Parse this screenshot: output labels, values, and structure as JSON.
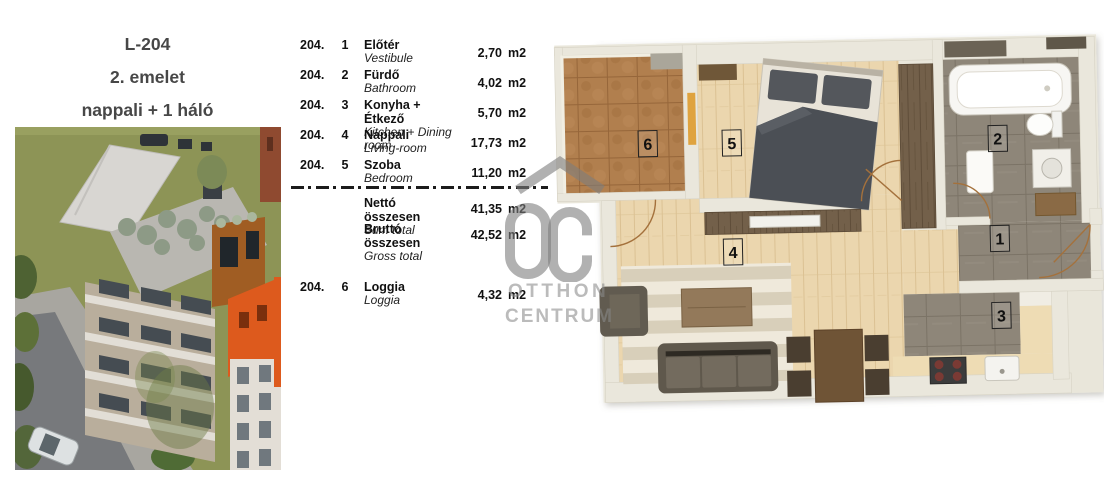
{
  "title_block": {
    "unit_id": "L-204",
    "floor": "2. emelet",
    "layout": "nappali + 1 háló"
  },
  "room_table": {
    "rows": [
      {
        "lot": "204.",
        "num": "1",
        "name_hu": "Előtér",
        "name_en": "Vestibule",
        "area": "2,70",
        "unit": "m2"
      },
      {
        "lot": "204.",
        "num": "2",
        "name_hu": "Fürdő",
        "name_en": "Bathroom",
        "area": "4,02",
        "unit": "m2"
      },
      {
        "lot": "204.",
        "num": "3",
        "name_hu": "Konyha + Étkező",
        "name_en": "Kitchen + Dining room",
        "area": "5,70",
        "unit": "m2"
      },
      {
        "lot": "204.",
        "num": "4",
        "name_hu": "Nappali",
        "name_en": "Living-room",
        "area": "17,73",
        "unit": "m2"
      },
      {
        "lot": "204.",
        "num": "5",
        "name_hu": "Szoba",
        "name_en": "Bedroom",
        "area": "11,20",
        "unit": "m2"
      }
    ],
    "totals": [
      {
        "label_hu": "Nettó összesen",
        "label_en": "Sum total",
        "area": "41,35",
        "unit": "m2"
      },
      {
        "label_hu": "Bruttó összesen",
        "label_en": "Gross total",
        "area": "42,52",
        "unit": "m2"
      }
    ],
    "extra": {
      "lot": "204.",
      "num": "6",
      "name_hu": "Loggia",
      "name_en": "Loggia",
      "area": "4,32",
      "unit": "m2"
    }
  },
  "watermark": {
    "monogram": "OC",
    "line1": "OTTHON",
    "line2": "CENTRUM"
  },
  "floor_plan": {
    "labels": {
      "vestibule": "1",
      "bathroom": "2",
      "kitchen": "3",
      "living": "4",
      "bedroom": "5",
      "loggia": "6"
    }
  },
  "colors": {
    "wood_floor": "#ebd6ae",
    "terracotta": "#b17f4e",
    "gray_tile": "#8e8679",
    "wall": "#eae7dc",
    "orange_building": "#dd5a1d",
    "olive_ground": "#8d9456",
    "watermark_gray": "#8a8a8a",
    "text": "#111111"
  }
}
